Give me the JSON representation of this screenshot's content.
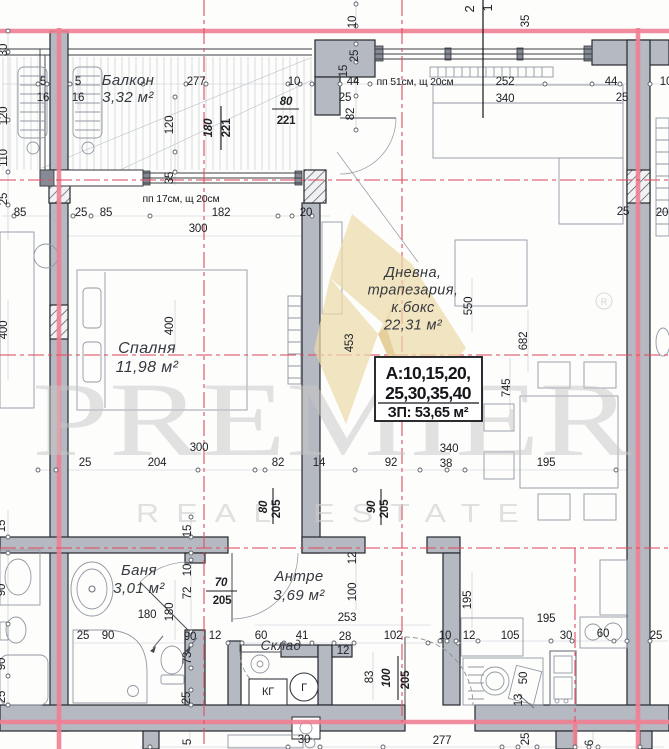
{
  "drawing": {
    "watermark": {
      "brand": "PREMIER",
      "tagline": "REAL ESTATE",
      "registered": "R"
    },
    "info_box": {
      "line1": "А:10,15,20,",
      "line2": "25,30,35,40",
      "line3": "ЗП: 53,65 м²"
    },
    "rooms": [
      {
        "lines": [
          "Балкон",
          "3,32 м²"
        ],
        "x": 128,
        "y": 85,
        "lh": 17,
        "s": 15
      },
      {
        "lines": [
          "Спалня",
          "11,98 м²"
        ],
        "x": 147,
        "y": 353,
        "lh": 19,
        "s": 16
      },
      {
        "lines": [
          "Дневна,",
          "трапезария,",
          "к.бокс",
          "22,31 м²"
        ],
        "x": 413,
        "y": 277,
        "lh": 17.5,
        "s": 14.5
      },
      {
        "lines": [
          "Баня",
          "3,01 м²"
        ],
        "x": 139,
        "y": 575,
        "lh": 18,
        "s": 15
      },
      {
        "lines": [
          "Антре",
          "3,69 м²"
        ],
        "x": 299,
        "y": 581,
        "lh": 19,
        "s": 15
      },
      {
        "lines": [
          "Склад"
        ],
        "x": 281,
        "y": 650,
        "lh": 15,
        "s": 13.5
      }
    ],
    "notes": [
      {
        "t": "пп 17см, щ 20см",
        "x": 181,
        "y": 202
      },
      {
        "t": "пп 51см, щ 20см",
        "x": 415,
        "y": 85
      }
    ],
    "appliances": [
      {
        "t": "КГ",
        "x": 268,
        "y": 695
      },
      {
        "t": "Г",
        "x": 304,
        "y": 691
      }
    ],
    "dims": [
      {
        "t": "30",
        "x": 7,
        "y": 50,
        "r": 1
      },
      {
        "t": "120",
        "x": 7,
        "y": 116,
        "r": 1
      },
      {
        "t": "110",
        "x": 7,
        "y": 158,
        "r": 1
      },
      {
        "t": "25",
        "x": 7,
        "y": 199,
        "r": 1
      },
      {
        "t": "400",
        "x": 7,
        "y": 330,
        "r": 1
      },
      {
        "t": "15",
        "x": 5,
        "y": 526,
        "r": 1
      },
      {
        "t": "90",
        "x": 5,
        "y": 590,
        "r": 1
      },
      {
        "t": "90",
        "x": 5,
        "y": 664,
        "r": 1
      },
      {
        "t": "25",
        "x": 5,
        "y": 697,
        "r": 1
      },
      {
        "t": "5",
        "x": 43,
        "y": 85
      },
      {
        "t": "16",
        "x": 43,
        "y": 101
      },
      {
        "t": "5",
        "x": 78,
        "y": 85
      },
      {
        "t": "16",
        "x": 78,
        "y": 101
      },
      {
        "t": "277",
        "x": 196,
        "y": 85
      },
      {
        "t": "10",
        "x": 294,
        "y": 85
      },
      {
        "t": "120",
        "x": 173,
        "y": 125,
        "r": 1
      },
      {
        "t": "35",
        "x": 173,
        "y": 178,
        "r": 1
      },
      {
        "t": "180",
        "x": 212,
        "y": 128,
        "r": 1,
        "b": 1,
        "i": 1
      },
      {
        "t": "221",
        "x": 230,
        "y": 128,
        "r": 1,
        "b": 1
      },
      {
        "t": "80",
        "x": 286,
        "y": 105,
        "b": 1,
        "i": 1
      },
      {
        "t": "221",
        "x": 286,
        "y": 124,
        "b": 1
      },
      {
        "t": "85",
        "x": 20,
        "y": 216
      },
      {
        "t": "25",
        "x": 81,
        "y": 216
      },
      {
        "t": "85",
        "x": 106,
        "y": 216
      },
      {
        "t": "182",
        "x": 221,
        "y": 216
      },
      {
        "t": "20",
        "x": 306,
        "y": 216
      },
      {
        "t": "300",
        "x": 198,
        "y": 232
      },
      {
        "t": "2",
        "x": 474,
        "y": 9,
        "r": 1,
        "s": 13
      },
      {
        "t": "1",
        "x": 492,
        "y": 8,
        "r": 1,
        "s": 13
      },
      {
        "t": "10",
        "x": 356,
        "y": 22,
        "r": 1
      },
      {
        "t": "35",
        "x": 529,
        "y": 21,
        "r": 1
      },
      {
        "t": "25",
        "x": 358,
        "y": 56,
        "r": 1
      },
      {
        "t": "15",
        "x": 347,
        "y": 71,
        "r": 1
      },
      {
        "t": "44",
        "x": 353,
        "y": 85
      },
      {
        "t": "252",
        "x": 505,
        "y": 85
      },
      {
        "t": "44",
        "x": 611,
        "y": 85
      },
      {
        "t": "10",
        "x": 666,
        "y": 85
      },
      {
        "t": "25",
        "x": 345,
        "y": 101
      },
      {
        "t": "340",
        "x": 505,
        "y": 102
      },
      {
        "t": "25",
        "x": 622,
        "y": 101
      },
      {
        "t": "82",
        "x": 354,
        "y": 114,
        "r": 1
      },
      {
        "t": "25",
        "x": 623,
        "y": 215
      },
      {
        "t": "20",
        "x": 662,
        "y": 216
      },
      {
        "t": "400",
        "x": 173,
        "y": 326,
        "r": 1
      },
      {
        "t": "300",
        "x": 199,
        "y": 451
      },
      {
        "t": "25",
        "x": 85,
        "y": 466
      },
      {
        "t": "204",
        "x": 157,
        "y": 466
      },
      {
        "t": "82",
        "x": 278,
        "y": 466
      },
      {
        "t": "14",
        "x": 319,
        "y": 466
      },
      {
        "t": "92",
        "x": 391,
        "y": 466
      },
      {
        "t": "38",
        "x": 446,
        "y": 467
      },
      {
        "t": "340",
        "x": 449,
        "y": 452
      },
      {
        "t": "195",
        "x": 546,
        "y": 466
      },
      {
        "t": "453",
        "x": 353,
        "y": 343,
        "r": 1
      },
      {
        "t": "550",
        "x": 472,
        "y": 306,
        "r": 1
      },
      {
        "t": "682",
        "x": 527,
        "y": 341,
        "r": 1
      },
      {
        "t": "745",
        "x": 510,
        "y": 388,
        "r": 1
      },
      {
        "t": "80",
        "x": 267,
        "y": 507,
        "r": 1,
        "b": 1,
        "i": 1
      },
      {
        "t": "205",
        "x": 280,
        "y": 509,
        "r": 1,
        "b": 1
      },
      {
        "t": "90",
        "x": 375,
        "y": 507,
        "r": 1,
        "b": 1,
        "i": 1
      },
      {
        "t": "205",
        "x": 388,
        "y": 509,
        "r": 1,
        "b": 1
      },
      {
        "t": "15",
        "x": 191,
        "y": 531,
        "r": 1
      },
      {
        "t": "10",
        "x": 191,
        "y": 570,
        "r": 1
      },
      {
        "t": "72",
        "x": 191,
        "y": 593,
        "r": 1
      },
      {
        "t": "73",
        "x": 191,
        "y": 658,
        "r": 1
      },
      {
        "t": "25",
        "x": 190,
        "y": 698,
        "r": 1
      },
      {
        "t": "70",
        "x": 221,
        "y": 586,
        "b": 1,
        "i": 1
      },
      {
        "t": "205",
        "x": 222,
        "y": 604,
        "b": 1
      },
      {
        "t": "180",
        "x": 147,
        "y": 618
      },
      {
        "t": "180",
        "x": 173,
        "y": 612,
        "r": 1
      },
      {
        "t": "25",
        "x": 83,
        "y": 639
      },
      {
        "t": "90",
        "x": 108,
        "y": 639
      },
      {
        "t": "90",
        "x": 190,
        "y": 640
      },
      {
        "t": "12",
        "x": 215,
        "y": 639
      },
      {
        "t": "12",
        "x": 356,
        "y": 558,
        "r": 1
      },
      {
        "t": "100",
        "x": 356,
        "y": 592,
        "r": 1
      },
      {
        "t": "253",
        "x": 347,
        "y": 621
      },
      {
        "t": "60",
        "x": 261,
        "y": 639
      },
      {
        "t": "41",
        "x": 302,
        "y": 639
      },
      {
        "t": "28",
        "x": 345,
        "y": 640
      },
      {
        "t": "102",
        "x": 393,
        "y": 639
      },
      {
        "t": "10",
        "x": 445,
        "y": 639
      },
      {
        "t": "12",
        "x": 343,
        "y": 654
      },
      {
        "t": "83",
        "x": 373,
        "y": 677,
        "r": 1
      },
      {
        "t": "100",
        "x": 390,
        "y": 678,
        "r": 1,
        "b": 1,
        "i": 1
      },
      {
        "t": "205",
        "x": 409,
        "y": 680,
        "r": 1,
        "b": 1
      },
      {
        "t": "12",
        "x": 469,
        "y": 639
      },
      {
        "t": "105",
        "x": 510,
        "y": 639
      },
      {
        "t": "30",
        "x": 566,
        "y": 639
      },
      {
        "t": "60",
        "x": 603,
        "y": 637
      },
      {
        "t": "25",
        "x": 656,
        "y": 639
      },
      {
        "t": "50",
        "x": 527,
        "y": 678,
        "r": 1
      },
      {
        "t": "13",
        "x": 522,
        "y": 700,
        "r": 1
      },
      {
        "t": "195",
        "x": 471,
        "y": 600,
        "r": 1
      },
      {
        "t": "195",
        "x": 546,
        "y": 622
      },
      {
        "t": "30",
        "x": 304,
        "y": 743
      },
      {
        "t": "277",
        "x": 442,
        "y": 744
      },
      {
        "t": "25",
        "x": 529,
        "y": 739,
        "r": 1
      },
      {
        "t": "6",
        "x": 593,
        "y": 743,
        "r": 1
      },
      {
        "t": "5",
        "x": 191,
        "y": 742,
        "r": 1
      }
    ]
  }
}
